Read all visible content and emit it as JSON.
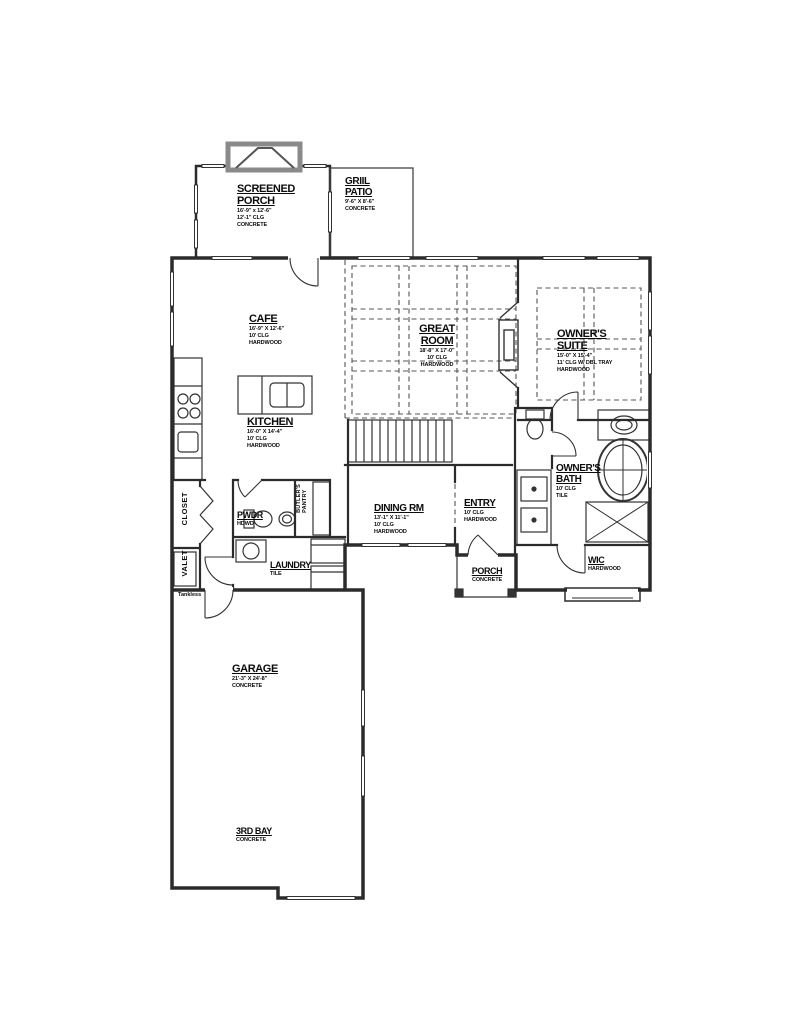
{
  "rooms": {
    "screened_porch": {
      "name": "SCREENED",
      "name2": "PORCH",
      "dims": "16'-9\" x 12'-6\"",
      "clg": "12'-1\" CLG",
      "floor": "CONCRETE"
    },
    "grill_patio": {
      "name": "GRIIL",
      "name2": "PATIO",
      "dims": "9'-6\" X 8'-6\"",
      "floor": "CONCRETE"
    },
    "cafe": {
      "name": "CAFE",
      "dims": "16'-9\" X 12'-6\"",
      "clg": "10' CLG",
      "floor": "HARDWOOD"
    },
    "great_room": {
      "name": "GREAT",
      "name2": "ROOM",
      "dims": "18'-8\" X 17'-0\"",
      "clg": "10' CLG",
      "floor": "HARDWOOD"
    },
    "owners_suite": {
      "name": "OWNER'S",
      "name2": "SUITE",
      "dims": "15'-0\" X 15'-4\"",
      "clg": "11' CLG W/ DBL TRAY",
      "floor": "HARDWOOD"
    },
    "kitchen": {
      "name": "KITCHEN",
      "dims": "16'-0\" X 14'-4\"",
      "clg": "10' CLG",
      "floor": "HARDWOOD"
    },
    "dining_room": {
      "name": "DINING RM",
      "dims": "13'-1\" X 11'-1\"",
      "clg": "10' CLG",
      "floor": "HARDWOOD"
    },
    "entry": {
      "name": "ENTRY",
      "clg": "10' CLG",
      "floor": "HARDWOOD"
    },
    "owners_bath": {
      "name": "OWNER'S",
      "name2": "BATH",
      "clg": "10' CLG",
      "floor": "TILE"
    },
    "powder": {
      "name": "PWDR",
      "floor": "HDWD"
    },
    "butlers_pantry": {
      "name": "BUTLER'S",
      "name2": "PANTRY"
    },
    "laundry": {
      "name": "LAUNDRY",
      "floor": "TILE"
    },
    "closet": {
      "name": "CLOSET"
    },
    "valet": {
      "name": "VALET"
    },
    "front_porch": {
      "name": "PORCH",
      "floor": "CONCRETE"
    },
    "wic": {
      "name": "WIC",
      "floor": "HARDWOOD"
    },
    "garage": {
      "name": "GARAGE",
      "dims": "21'-3\" X 24'-8\"",
      "floor": "CONCRETE"
    },
    "third_bay": {
      "name": "3RD BAY",
      "floor": "CONCRETE"
    }
  },
  "notes": {
    "tankless": "Tankless"
  },
  "colors": {
    "wall": "#2b2b2b",
    "dashed": "#555555",
    "chimney": "#8a8a8a",
    "background": "#ffffff"
  }
}
